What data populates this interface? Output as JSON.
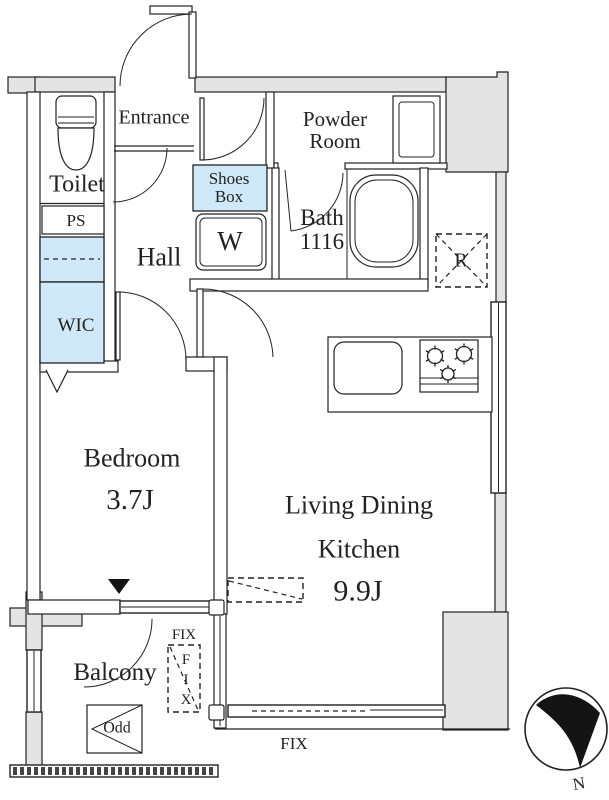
{
  "title": "apartment-floor-plan",
  "colors": {
    "accent_blue": "#cfe9f8",
    "wall_gray": "#e4e4e4",
    "line": "#222222"
  },
  "rooms": {
    "entrance": "Entrance",
    "toilet": "Toilet",
    "ps": "PS",
    "wic": "WIC",
    "hall": "Hall",
    "shoes_box": [
      "Shoes",
      "Box"
    ],
    "washer": "W",
    "powder_room": [
      "Powder",
      "Room"
    ],
    "bath": [
      "Bath",
      "1116"
    ],
    "refrigerator": "R",
    "bedroom": [
      "Bedroom",
      "3.7J"
    ],
    "ldk": [
      "Living Dining",
      "Kitchen",
      "9.9J"
    ],
    "balcony": "Balcony",
    "odd": "Odd"
  },
  "windows": {
    "fix_side_label": "FIX",
    "fix_side_letters": [
      "F",
      "I",
      "X"
    ],
    "fix_bottom_label": "FIX"
  },
  "compass": {
    "north_label": "N"
  }
}
